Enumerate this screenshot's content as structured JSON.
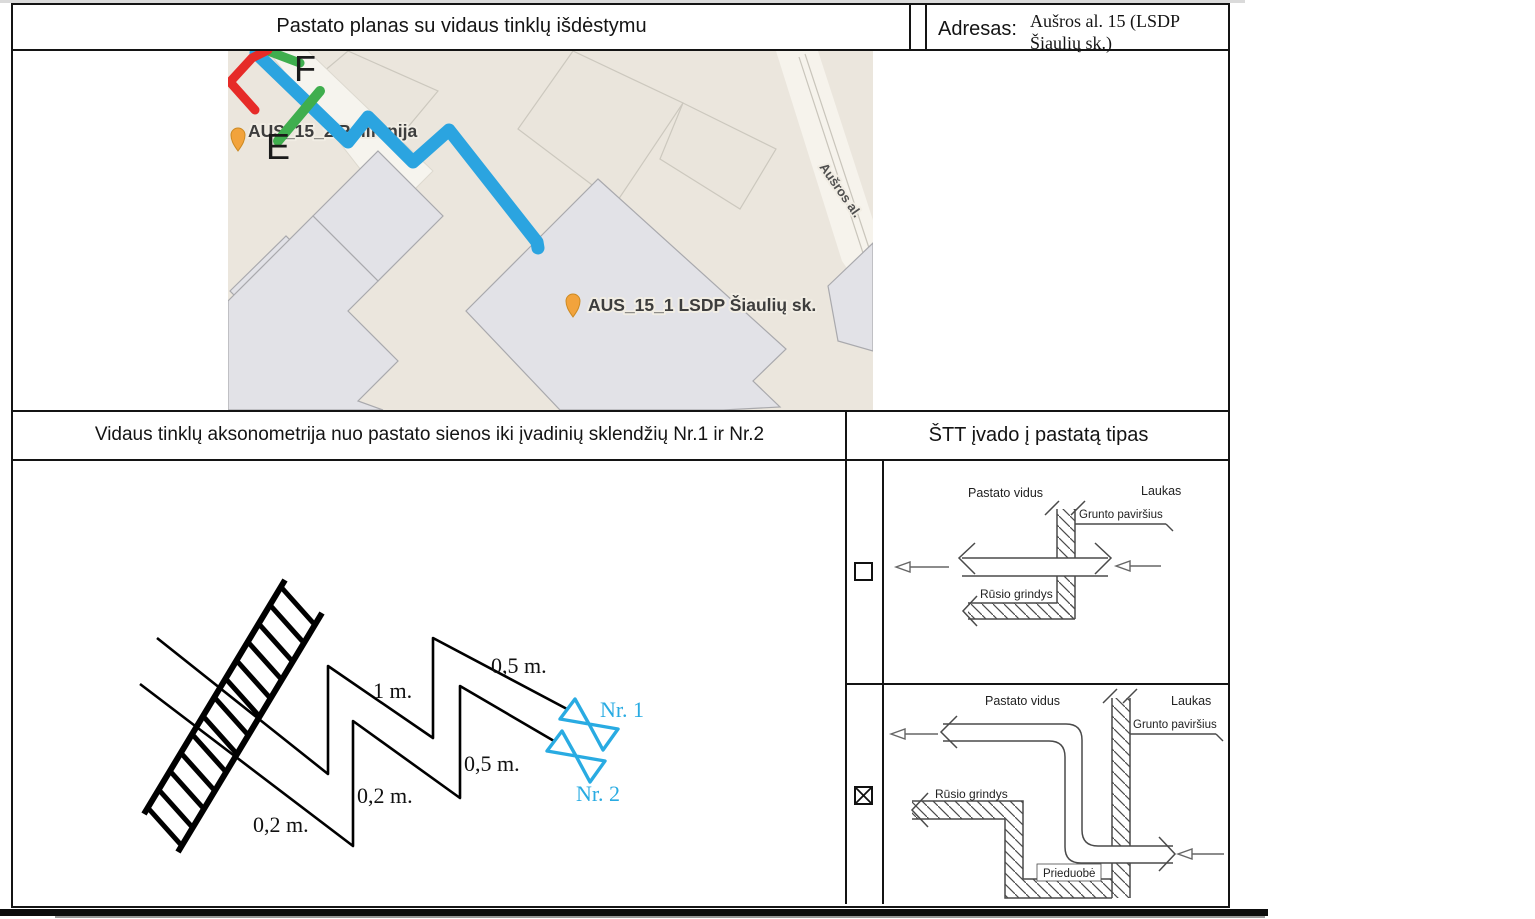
{
  "header": {
    "title": "Pastato planas su vidaus tinklų išdėstymu",
    "address_label": "Adresas:",
    "address_line1": "Aušros al. 15 (LSDP",
    "address_line2": "Šiaulių sk.)"
  },
  "map": {
    "point_f": "F",
    "point_e": "E",
    "marker1_label": "AUS_15_2 Polifonija",
    "marker2_label": "AUS_15_1 LSDP Šiaulių sk.",
    "street_label": "Aušros al.",
    "route_color": "#2ba4e0",
    "marker_color": "#f2a33c",
    "highlight_red": "#e62b28",
    "highlight_green": "#3fae4e"
  },
  "sections": {
    "axonometry_title": "Vidaus tinklų aksonometrija nuo pastato sienos iki įvadinių sklendžių Nr.1 ir Nr.2",
    "entry_type_title": "ŠTT įvado į pastatą tipas"
  },
  "axonometry": {
    "dim_1m": "1 m.",
    "dim_05m_top": "0,5 m.",
    "dim_05m_mid": "0,5 m.",
    "dim_02m_mid": "0,2 m.",
    "dim_02m_bottom": "0,2 m.",
    "valve1_label": "Nr. 1",
    "valve2_label": "Nr. 2",
    "valve_color": "#29abe2"
  },
  "entry_types": [
    {
      "checked": false,
      "checkbox_icon": "checkbox-empty-icon",
      "labels": {
        "inside": "Pastato vidus",
        "outside": "Laukas",
        "ground": "Grunto paviršius",
        "basement_floor": "Rūsio grindys"
      }
    },
    {
      "checked": true,
      "checkbox_icon": "checkbox-checked-icon",
      "labels": {
        "inside": "Pastato vidus",
        "outside": "Laukas",
        "ground": "Grunto paviršius",
        "basement_floor": "Rūsio grindys",
        "pit": "Prieduobė"
      }
    }
  ]
}
